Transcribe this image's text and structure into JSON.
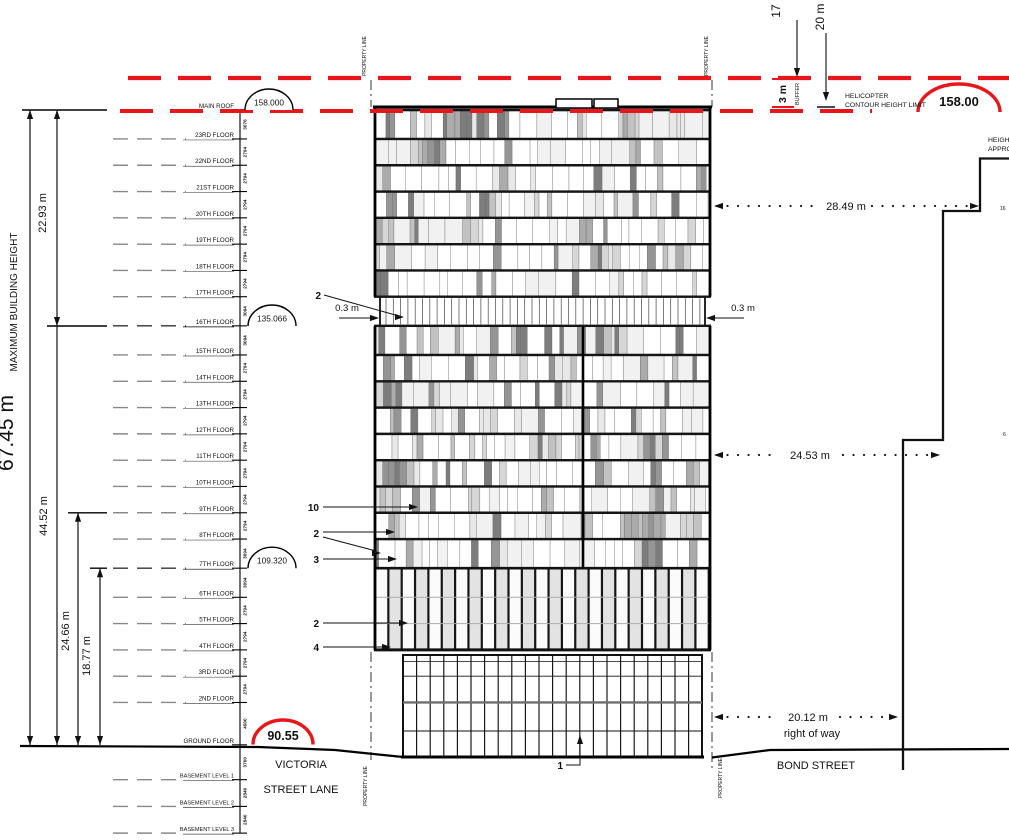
{
  "drawing": {
    "accent_red": "#e8151b",
    "max_height": {
      "value": "67.45 m",
      "caption": "MAXIMUM BUILDING HEIGHT"
    },
    "left_dims": {
      "upper": "22.93 m",
      "lower": "44.52 m",
      "mid": "24.66 m",
      "inner": "18.77 m"
    },
    "top_dims": {
      "left": "17",
      "right": "20 m",
      "buffer": "3 m",
      "buffer_caption": "BUFFER"
    },
    "helicopter": {
      "line1": "HELICOPTER",
      "line2": "CONTOUR HEIGHT LIMIT",
      "value": "158.00"
    },
    "levels": {
      "main_roof": "158.000",
      "floor_16": "135.066",
      "floor_7": "109.320",
      "ground": "90.55"
    },
    "floors": [
      {
        "label": "MAIN ROOF",
        "level": "158.000",
        "dim_below": "3076",
        "style": "key"
      },
      {
        "label": "23RD FLOOR",
        "dim_below": "2794"
      },
      {
        "label": "22ND FLOOR",
        "dim_below": "2794"
      },
      {
        "label": "21ST FLOOR",
        "dim_below": "2794"
      },
      {
        "label": "20TH FLOOR",
        "dim_below": "2794"
      },
      {
        "label": "19TH FLOOR",
        "dim_below": "2794"
      },
      {
        "label": "18TH FLOOR",
        "dim_below": "2794"
      },
      {
        "label": "17TH FLOOR",
        "dim_below": "3094"
      },
      {
        "label": "16TH FLOOR",
        "level": "135.066",
        "dim_below": "3094",
        "style": "key"
      },
      {
        "label": "15TH FLOOR",
        "dim_below": "2794"
      },
      {
        "label": "14TH FLOOR",
        "dim_below": "2794"
      },
      {
        "label": "13TH FLOOR",
        "dim_below": "2794"
      },
      {
        "label": "12TH FLOOR",
        "dim_below": "2794"
      },
      {
        "label": "11TH FLOOR",
        "dim_below": "2794"
      },
      {
        "label": "10TH FLOOR",
        "dim_below": "2794"
      },
      {
        "label": "9TH FLOOR",
        "dim_below": "2794"
      },
      {
        "label": "8TH FLOOR",
        "dim_below": "3094"
      },
      {
        "label": "7TH FLOOR",
        "level": "109.320",
        "dim_below": "3094",
        "style": "key"
      },
      {
        "label": "6TH FLOOR",
        "dim_below": "2794"
      },
      {
        "label": "5TH FLOOR",
        "dim_below": "2794"
      },
      {
        "label": "4TH FLOOR",
        "dim_below": "2794"
      },
      {
        "label": "3RD FLOOR",
        "dim_below": "2794"
      },
      {
        "label": "2ND FLOOR",
        "dim_below": "4500"
      },
      {
        "label": "GROUND FLOOR",
        "level": "90.55",
        "dim_below": "3700",
        "style": "ground"
      },
      {
        "label": "BASEMENT LEVEL 1",
        "dim_below": "2840",
        "style": "basement"
      },
      {
        "label": "BASEMENT LEVEL 2",
        "dim_below": "2840",
        "style": "basement"
      },
      {
        "label": "BASEMENT LEVEL 3",
        "style": "basement"
      }
    ],
    "horizontal_dims": {
      "upper": "28.49 m",
      "middle": "24.53 m",
      "lower": "20.12 m",
      "lower_caption": "right of way"
    },
    "setback": {
      "left": "0.3 m",
      "right": "0.3 m"
    },
    "callouts": [
      "2",
      "10",
      "2",
      "3",
      "2",
      "4",
      "1"
    ],
    "streets": {
      "victoria_line1": "VICTORIA",
      "victoria_line2": "STREET LANE",
      "bond": "BOND STREET"
    },
    "property_line": "PROPERTY LINE",
    "neighbor": {
      "caption1": "HEIGH",
      "caption2": "APPRO",
      "tag_upper": "16",
      "tag_lower": "6"
    }
  }
}
